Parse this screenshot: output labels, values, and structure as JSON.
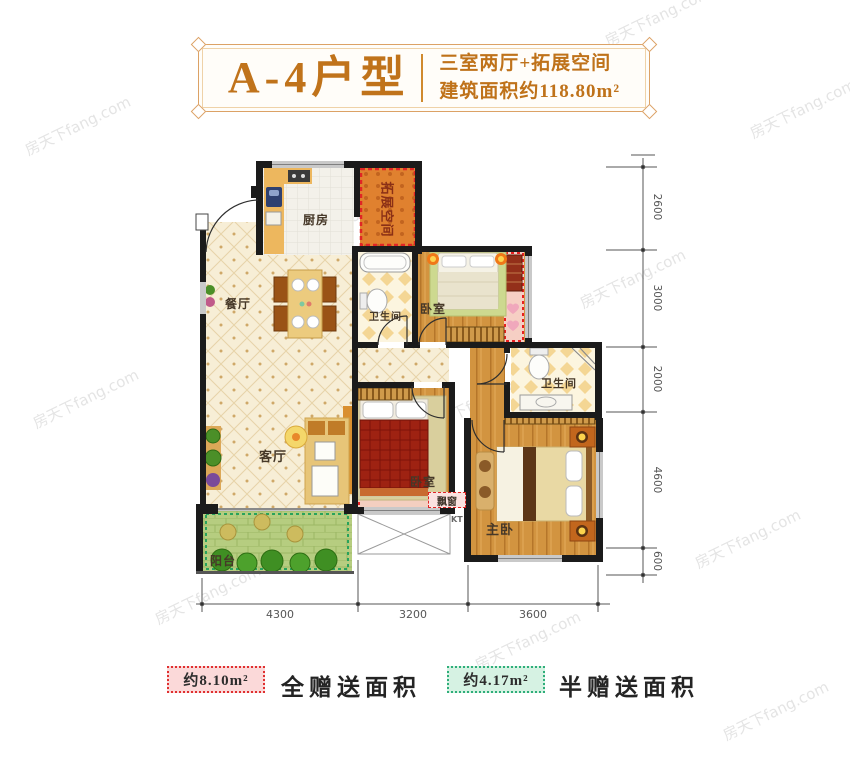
{
  "title": {
    "unit_name": "A-4户型",
    "desc_line1": "三室两厅+拓展空间",
    "desc_line2": "建筑面积约118.80m²"
  },
  "rooms": {
    "kitchen": "厨房",
    "expansion": "拓展空间",
    "dining": "餐厅",
    "bathroom1": "卫生间",
    "bedroom2": "卧室",
    "bathroom2": "卫生间",
    "living": "客厅",
    "bedroom1": "卧室",
    "master": "主卧",
    "balcony": "阳台",
    "bay_window": "飘窗",
    "kt": "KT"
  },
  "dimensions": {
    "right": [
      {
        "label": "2600"
      },
      {
        "label": "3000"
      },
      {
        "label": "2000"
      },
      {
        "label": "4600"
      },
      {
        "label": "600"
      }
    ],
    "bottom": [
      {
        "label": "4300"
      },
      {
        "label": "3200"
      },
      {
        "label": "3600"
      }
    ]
  },
  "legend": {
    "full_gift": {
      "area": "约8.10m²",
      "label": "全赠送面积"
    },
    "half_gift": {
      "area": "约4.17m²",
      "label": "半赠送面积"
    }
  },
  "watermark": {
    "text": "房天下fang.com"
  },
  "colors": {
    "accent_orange": "#c0731b",
    "wall_black": "#1b1b1b",
    "gift_red": "#e03030",
    "gift_green": "#2fae7a",
    "expansion_fill": "#e0812f",
    "wood_floor": "#d29440",
    "balcony_green": "#b6cd80"
  }
}
